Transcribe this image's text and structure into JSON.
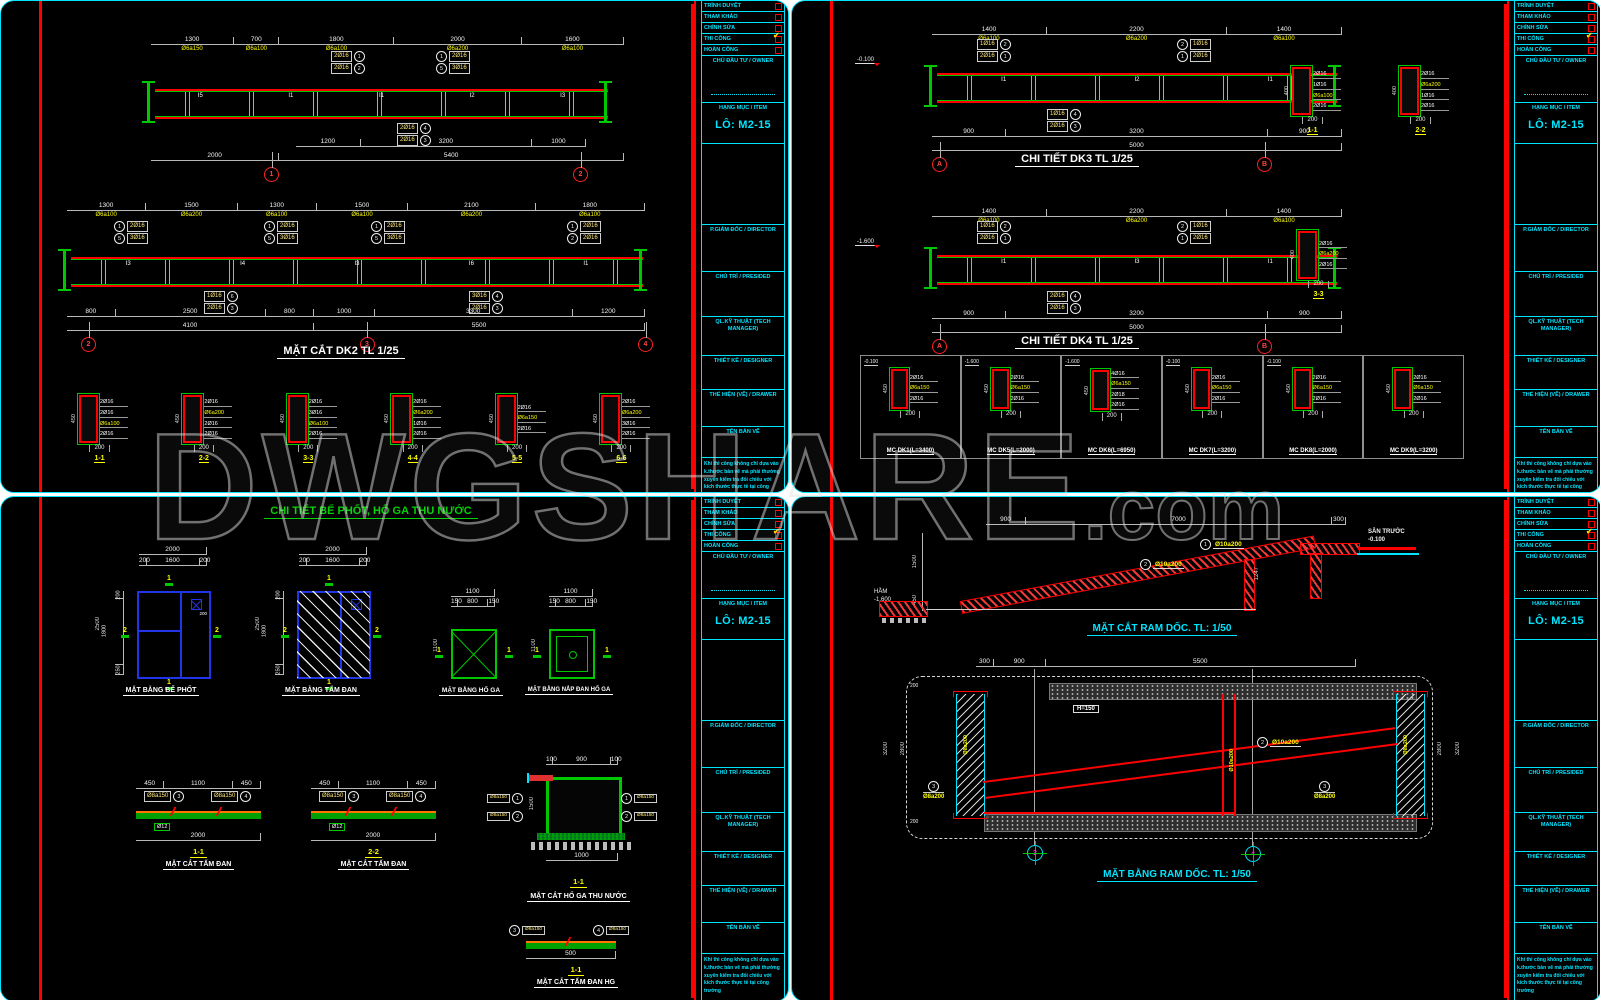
{
  "watermark": {
    "main": "DWGSHARE",
    "suffix": ".com"
  },
  "titleblock": {
    "approvals": [
      {
        "label": "TRÌNH DUYỆT",
        "mark": ""
      },
      {
        "label": "THAM KHẢO",
        "mark": ""
      },
      {
        "label": "CHỈNH SỬA",
        "mark": ""
      },
      {
        "label": "THI CÔNG",
        "mark": "✔"
      },
      {
        "label": "HOÀN CÔNG",
        "mark": ""
      }
    ],
    "owner_label": "CHỦ ĐẦU TƯ / OWNER",
    "item_label": "HẠNG MỤC / ITEM",
    "lot": "LÔ: M2-15",
    "director_label": "P.GIÁM ĐỐC / DIRECTOR",
    "president_label": "CHỦ TRÌ / PRESIDED",
    "tech_label": "QL.KỸ THUẬT (TECH MANAGER)",
    "designer_label": "THIẾT KẾ / DESIGNER",
    "drawer_label": "THỂ HIỆN (VẼ) / DRAWER",
    "name_label": "TÊN BẢN VẼ",
    "note": "Khi thi công không chỉ dựa vào k.thước bản vẽ mà phải thường xuyên kiểm tra đối chiếu với kích thước thực tế tại công trường"
  },
  "tl": {
    "beam1": {
      "top_segs": [
        {
          "d": "1300",
          "s": "Ø6a150"
        },
        {
          "d": "700",
          "s": "Ø6a100"
        },
        {
          "d": "1800",
          "s": "Ø6a100"
        },
        {
          "d": "2000",
          "s": "Ø6a200"
        },
        {
          "d": "1600",
          "s": "Ø6a100"
        }
      ],
      "marks": [
        "I5",
        "I1",
        "I1",
        "I2",
        "I3"
      ],
      "co_tl": [
        {
          "t": "2Ø16",
          "n": "1"
        },
        {
          "t": "2Ø16",
          "n": "2"
        }
      ],
      "co_tr": [
        {
          "t": "2Ø16",
          "n": "1"
        },
        {
          "t": "3Ø16",
          "n": "5"
        }
      ],
      "co_b": [
        {
          "t": "2Ø16",
          "n": "4"
        },
        {
          "t": "2Ø16",
          "n": "3"
        }
      ],
      "bot1": [
        {
          "d": "1200"
        },
        {
          "d": "3200"
        },
        {
          "d": "1000"
        }
      ],
      "bot2": [
        {
          "d": "2000"
        },
        {
          "d": "5400"
        }
      ],
      "bubbles": [
        "1",
        "2"
      ]
    },
    "beam2": {
      "top_segs": [
        {
          "d": "1300",
          "s": "Ø6a100"
        },
        {
          "d": "1500",
          "s": "Ø6a200"
        },
        {
          "d": "1300",
          "s": "Ø6a100"
        },
        {
          "d": "1500",
          "s": "Ø6a100"
        },
        {
          "d": "2100",
          "s": "Ø6a200"
        },
        {
          "d": "1800",
          "s": "Ø6a100"
        }
      ],
      "marks": [
        "I3",
        "I4",
        "I3",
        "I6",
        "I1"
      ],
      "co1": [
        {
          "t": "2Ø16",
          "n": "1"
        },
        {
          "t": "3Ø16",
          "n": "5"
        }
      ],
      "co2": [
        {
          "t": "2Ø16",
          "n": "1"
        },
        {
          "t": "3Ø16",
          "n": "5"
        }
      ],
      "co3": [
        {
          "t": "2Ø16",
          "n": "1"
        },
        {
          "t": "3Ø16",
          "n": "5"
        }
      ],
      "co4": [
        {
          "t": "2Ø16",
          "n": "1"
        },
        {
          "t": "2Ø16",
          "n": "2"
        }
      ],
      "cob1": [
        {
          "t": "1Ø16",
          "n": "6"
        },
        {
          "t": "2Ø16",
          "n": "3"
        }
      ],
      "cob2": [
        {
          "t": "3Ø16",
          "n": "4"
        },
        {
          "t": "2Ø16",
          "n": "3"
        }
      ],
      "bot1": [
        {
          "d": "800"
        },
        {
          "d": "2500"
        },
        {
          "d": "800"
        },
        {
          "d": "1000"
        },
        {
          "d": "3300"
        },
        {
          "d": "1200"
        }
      ],
      "bot2": [
        {
          "d": "4100"
        },
        {
          "d": "5500"
        }
      ],
      "bubbles": [
        "2",
        "3",
        "4"
      ],
      "title": "MẶT CẮT DK2 TL 1/25"
    },
    "sections": [
      {
        "title": "1-1",
        "r1": "2Ø16",
        "r2": "2Ø16",
        "r3": "Ø6a100",
        "r4": "2Ø16",
        "h": "450",
        "w": "200"
      },
      {
        "title": "2-2",
        "r1": "2Ø16",
        "r2": "Ø6a200",
        "r3": "2Ø16",
        "r4": "2Ø16",
        "h": "450",
        "w": "200"
      },
      {
        "title": "3-3",
        "r1": "2Ø16",
        "r2": "3Ø16",
        "r3": "Ø6a100",
        "r4": "2Ø16",
        "h": "450",
        "w": "200"
      },
      {
        "title": "4-4",
        "r1": "2Ø16",
        "r2": "Ø6a200",
        "r3": "1Ø16",
        "r4": "2Ø16",
        "h": "450",
        "w": "200"
      },
      {
        "title": "5-5",
        "r1": "2Ø16",
        "r2": "Ø6a150",
        "r3": "2Ø16",
        "r4": "",
        "h": "450",
        "w": "200"
      },
      {
        "title": "6-6",
        "r1": "2Ø16",
        "r2": "Ø6a200",
        "r3": "3Ø16",
        "r4": "2Ø16",
        "h": "450",
        "w": "200"
      }
    ]
  },
  "tr": {
    "dk3": {
      "top_segs": [
        {
          "d": "1400",
          "s": "Ø6a100"
        },
        {
          "d": "2200",
          "s": "Ø6a200"
        },
        {
          "d": "1400",
          "s": "Ø6a100"
        }
      ],
      "marks": [
        "I1",
        "I2",
        "I1"
      ],
      "elev": "-0.100",
      "co_l": [
        {
          "t": "1Ø16",
          "n": "2"
        },
        {
          "t": "2Ø16",
          "n": "1"
        }
      ],
      "co_r": [
        {
          "t": "1Ø16",
          "n": "2"
        },
        {
          "t": "2Ø16",
          "n": "1"
        }
      ],
      "co_b": [
        {
          "t": "1Ø16",
          "n": "4"
        },
        {
          "t": "2Ø16",
          "n": "3"
        }
      ],
      "bot1": [
        {
          "d": "900"
        },
        {
          "d": "3200"
        },
        {
          "d": "900"
        }
      ],
      "bot2": [
        {
          "d": "5000"
        }
      ],
      "bubbles": [
        "A",
        "B"
      ],
      "title": "CHI TIẾT DK3 TL 1/25"
    },
    "dk4": {
      "top_segs": [
        {
          "d": "1400",
          "s": "Ø6a100"
        },
        {
          "d": "2200",
          "s": "Ø6a200"
        },
        {
          "d": "1400",
          "s": "Ø6a100"
        }
      ],
      "marks": [
        "I1",
        "I3",
        "I1"
      ],
      "elev": "-1.600",
      "co_l": [
        {
          "t": "1Ø16",
          "n": "2"
        },
        {
          "t": "2Ø16",
          "n": "1"
        }
      ],
      "co_r": [
        {
          "t": "1Ø16",
          "n": "2"
        },
        {
          "t": "2Ø16",
          "n": "1"
        }
      ],
      "co_b": [
        {
          "t": "2Ø16",
          "n": "4"
        },
        {
          "t": "2Ø16",
          "n": "3"
        }
      ],
      "bot1": [
        {
          "d": "900"
        },
        {
          "d": "3200"
        },
        {
          "d": "900"
        }
      ],
      "bot2": [
        {
          "d": "5000"
        }
      ],
      "bubbles": [
        "A",
        "B"
      ],
      "title": "CHI TIẾT DK4 TL 1/25"
    },
    "secs12": [
      {
        "title": "1-1",
        "r1": "2Ø16",
        "r2": "1Ø16",
        "r3": "Ø6a100",
        "r4": "2Ø16",
        "h": "400",
        "w": "200"
      },
      {
        "title": "2-2",
        "r1": "2Ø16",
        "r2": "Ø6a200",
        "r3": "1Ø16",
        "r4": "2Ø16",
        "h": "400",
        "w": "200"
      }
    ],
    "secs3": [
      {
        "title": "3-3",
        "r1": "2Ø16",
        "r2": "Ø6a200",
        "r3": "2Ø16",
        "r4": "",
        "h": "400",
        "w": "200"
      }
    ],
    "mc": [
      {
        "elev": "-0.100",
        "r1": "2Ø16",
        "r2": "Ø6a150",
        "r3": "2Ø16",
        "r4": "",
        "w": "200",
        "h": "450",
        "title": "MC DK1(L=3400)"
      },
      {
        "elev": "-1.600",
        "r1": "2Ø16",
        "r2": "Ø6a150",
        "r3": "2Ø16",
        "r4": "",
        "w": "200",
        "h": "450",
        "title": "MC DK5(L=2000)"
      },
      {
        "elev": "-1.600",
        "r1": "4Ø16",
        "r2": "Ø6a150",
        "r3": "2Ø18",
        "r4": "2Ø16",
        "w": "200",
        "h": "450",
        "title": "MC DK6(L=6950)"
      },
      {
        "elev": "-0.100",
        "r1": "2Ø16",
        "r2": "Ø6a150",
        "r3": "2Ø16",
        "r4": "",
        "w": "200",
        "h": "450",
        "title": "MC DK7(L=3200)"
      },
      {
        "elev": "-0.100",
        "r1": "2Ø16",
        "r2": "Ø6a150",
        "r3": "2Ø16",
        "r4": "",
        "w": "200",
        "h": "450",
        "title": "MC DK8(L=2000)"
      },
      {
        "elev": "",
        "r1": "2Ø16",
        "r2": "Ø6a150",
        "r3": "2Ø16",
        "r4": "",
        "w": "200",
        "h": "450",
        "title": "MC DK9(L=3200)"
      }
    ]
  },
  "bl": {
    "title": "CHI TIẾT BỂ PHỐT, HỐ GA THU NƯỚC",
    "plan1": {
      "total_w": [
        {
          "d": "2000"
        }
      ],
      "wsegs": [
        {
          "d": "200"
        },
        {
          "d": "1600"
        },
        {
          "d": "200"
        }
      ],
      "total_h": "2500",
      "hsegs": [
        {
          "d": "200"
        },
        {
          "d": "1800"
        },
        {
          "d": "250"
        }
      ],
      "hole": "200",
      "m1": "1",
      "m2": "2",
      "title": "MẶT BẰNG BỂ PHỐT"
    },
    "plan2": {
      "total_w": [
        {
          "d": "2000"
        }
      ],
      "wsegs": [
        {
          "d": "200"
        },
        {
          "d": "1600"
        },
        {
          "d": "200"
        }
      ],
      "total_h": "2500",
      "hsegs": [
        {
          "d": "200"
        },
        {
          "d": "1800"
        },
        {
          "d": "250"
        }
      ],
      "m1": "1",
      "m2": "2",
      "title": "MẶT BẰNG TẤM ĐAN"
    },
    "plan3": {
      "total_w": [
        {
          "d": "1100"
        }
      ],
      "wsegs": [
        {
          "d": "150"
        },
        {
          "d": "800"
        },
        {
          "d": "150"
        }
      ],
      "total_h": "1100",
      "m1": "1",
      "title": "MẶT BẰNG HỐ GA"
    },
    "plan4": {
      "total_w": [
        {
          "d": "1100"
        }
      ],
      "wsegs": [
        {
          "d": "150"
        },
        {
          "d": "800"
        },
        {
          "d": "150"
        }
      ],
      "total_h": "1100",
      "m1": "1",
      "title": "MẶT BẰNG NẮP ĐAN HỐ GA"
    },
    "slab1": {
      "segs": [
        {
          "d": "450"
        },
        {
          "d": "1100"
        },
        {
          "d": "450"
        }
      ],
      "total": [
        {
          "d": "2000"
        }
      ],
      "lab1": {
        "t": "Ø8a150",
        "n": "3"
      },
      "lab2": {
        "t": "Ø8a150",
        "n": "4"
      },
      "lab3": "Ø12",
      "no": "1-1",
      "title": "MẶT CẮT TẤM ĐAN"
    },
    "slab2": {
      "segs": [
        {
          "d": "450"
        },
        {
          "d": "1100"
        },
        {
          "d": "450"
        }
      ],
      "total": [
        {
          "d": "2000"
        }
      ],
      "lab1": {
        "t": "Ø8a150",
        "n": "3"
      },
      "lab2": {
        "t": "Ø8a150",
        "n": "4"
      },
      "lab3": "Ø12",
      "no": "2-2",
      "title": "MẶT CẮT TẤM ĐAN"
    },
    "hoga": {
      "wsegs": [
        {
          "d": "100"
        },
        {
          "d": "900"
        },
        {
          "d": "100"
        }
      ],
      "total": [
        {
          "d": "1000"
        }
      ],
      "hside": "1500",
      "lab_lu": {
        "t": "Ø8a150",
        "n": "1"
      },
      "lab_ll": {
        "t": "Ø8a150",
        "n": "2"
      },
      "lab_ru": {
        "t": "Ø8a150",
        "n": "1"
      },
      "lab_rl": {
        "t": "Ø8a150",
        "n": "2"
      },
      "no": "1-1",
      "title": "MẶT CẮT HỐ GA THU NƯỚC"
    },
    "danhg": {
      "lab1": {
        "t": "Ø8a150",
        "n": "3"
      },
      "lab2": {
        "t": "Ø8a150",
        "n": "4"
      },
      "total": [
        {
          "d": "500"
        }
      ],
      "no": "1-1",
      "title": "MẶT CẮT TẤM ĐAN HG"
    }
  },
  "br": {
    "sec": {
      "top_segs": [
        {
          "d": "900"
        },
        {
          "d": "7000"
        },
        {
          "d": "300"
        }
      ],
      "dim_l1": "1500",
      "dim_l2": "450",
      "dim_c": "1247",
      "ham": "HẦM",
      "ham_lv": "-1.600",
      "san": "SÂN TRƯỚC",
      "san_lv": "-0.100",
      "lab1": {
        "t": "Ø10a200",
        "n": "1"
      },
      "lab2": {
        "t": "Ø10a200",
        "n": "2"
      },
      "title": "MẶT CẮT RAM DỐC. TL: 1/50"
    },
    "plan": {
      "top_segs": [
        {
          "d": "300"
        },
        {
          "d": "900"
        },
        {
          "d": "5500"
        }
      ],
      "l1": "3200",
      "l2": "2800",
      "l3": "200",
      "l4": "200",
      "r1": "2800",
      "r2": "3200",
      "h_label": "H=150",
      "lab1": {
        "t": "Ø10a200",
        "n": "1"
      },
      "lab2": {
        "t": "Ø10a200",
        "n": "2"
      },
      "lab3": {
        "t": "Ø8a200",
        "n": "3"
      },
      "lab4": {
        "t": "Ø8a200",
        "n": "4"
      },
      "bubbles": [
        "3",
        "4"
      ],
      "title": "MẶT BẰNG RAM DỐC. TL: 1/50"
    }
  }
}
